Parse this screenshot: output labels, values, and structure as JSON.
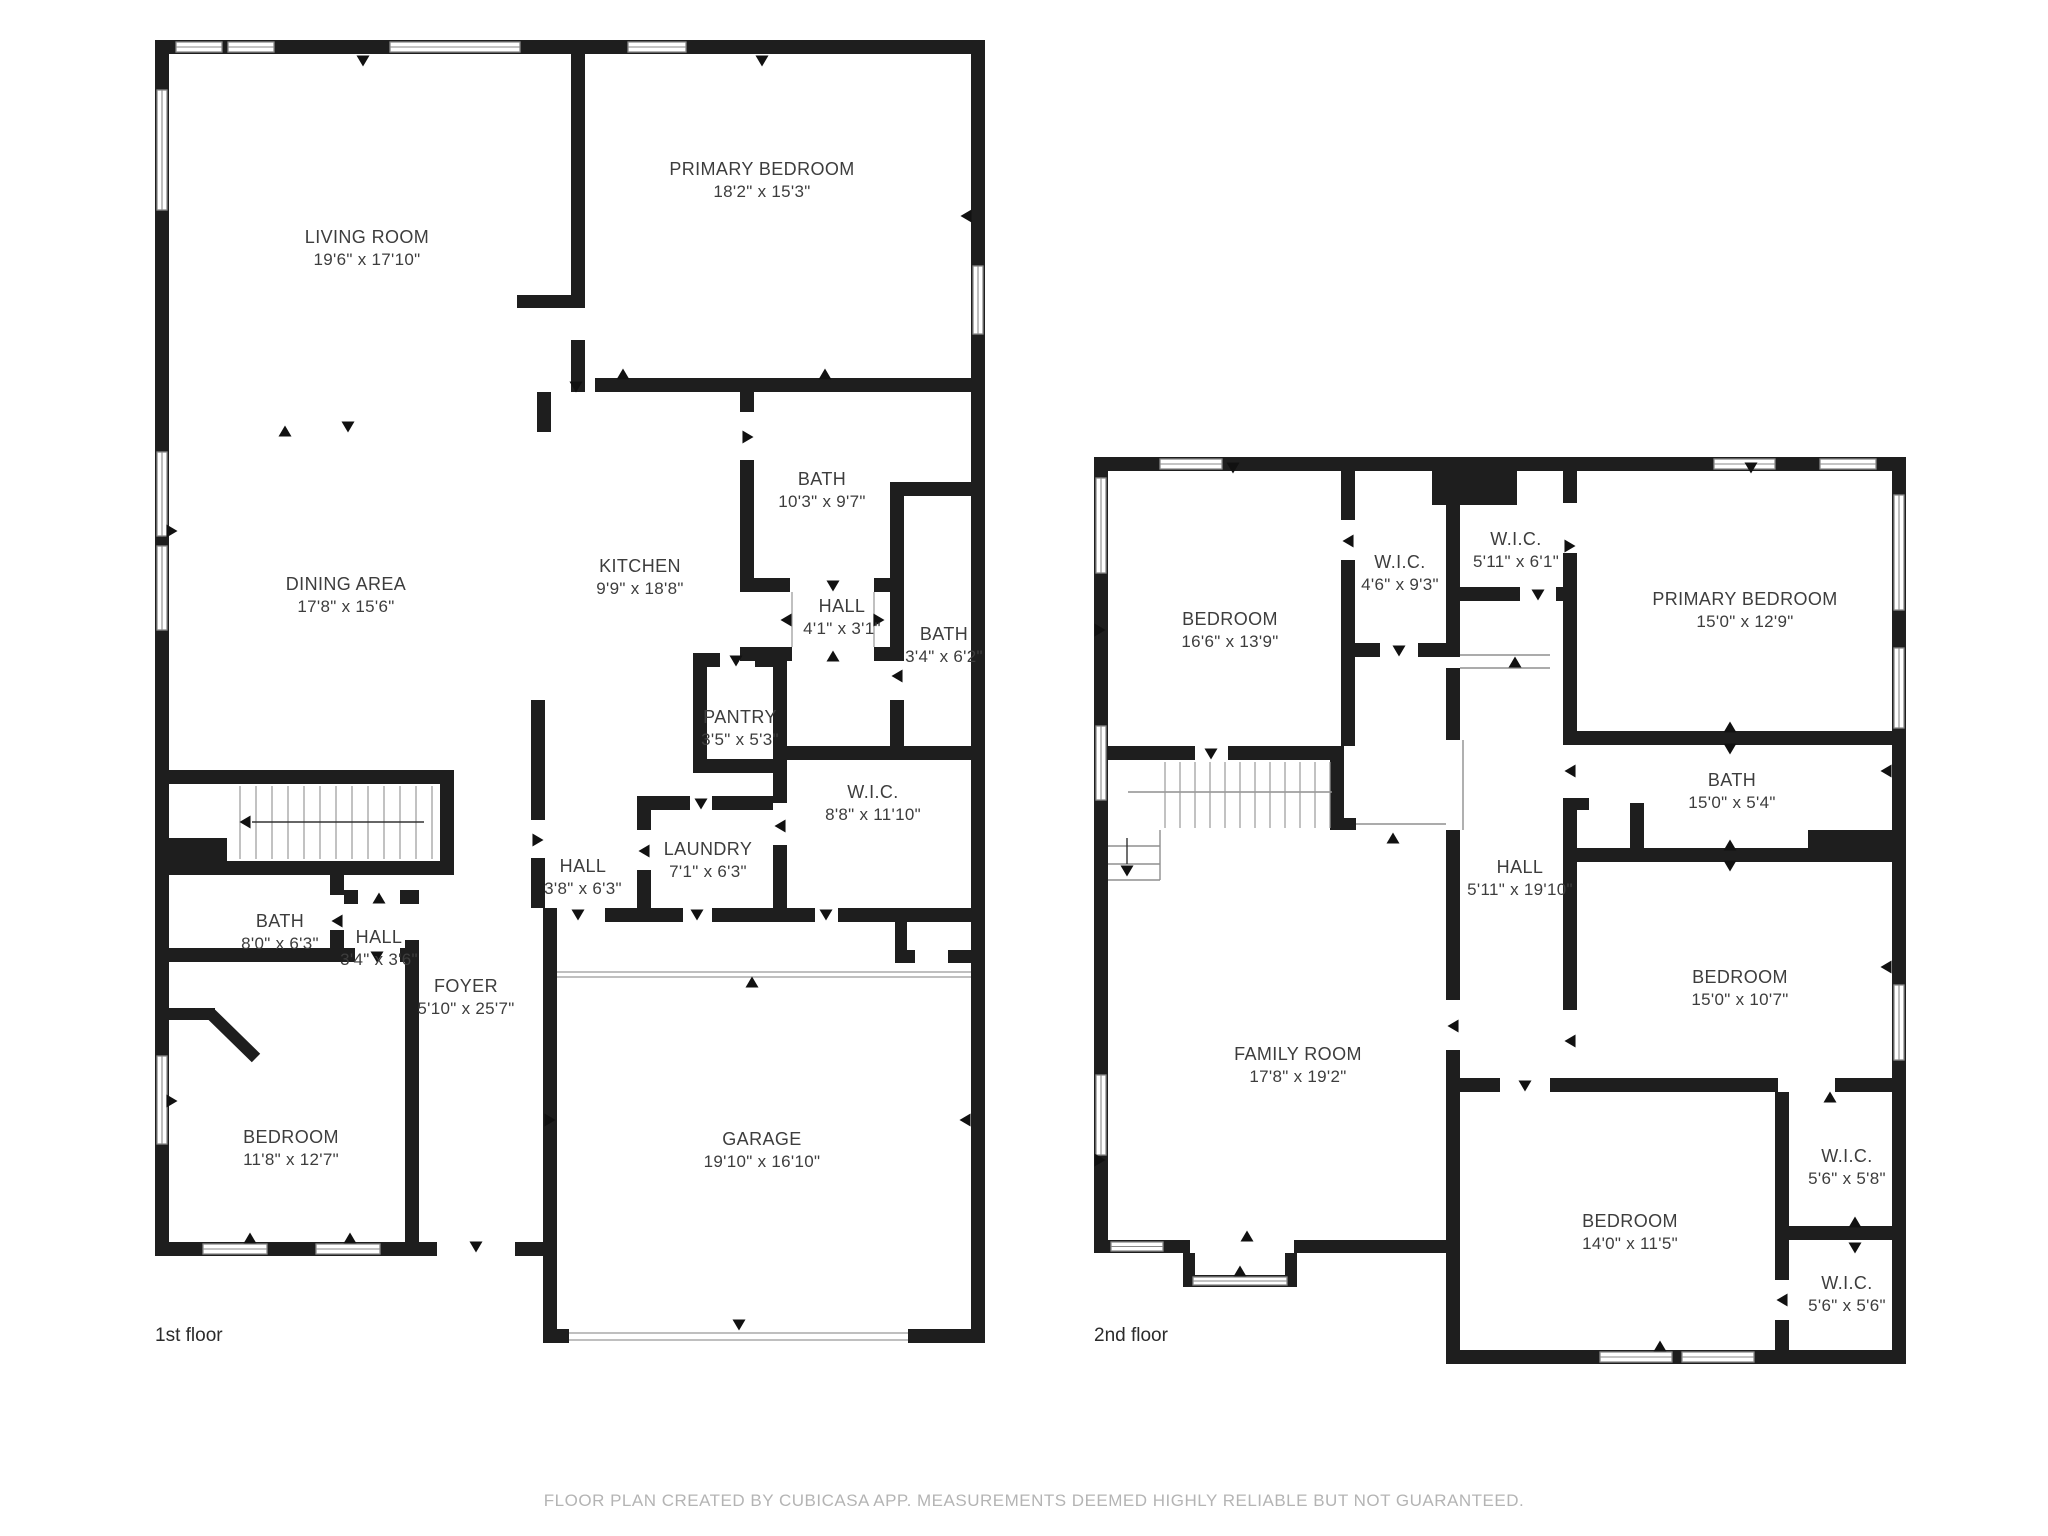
{
  "canvas": {
    "width": 2048,
    "height": 1536,
    "background": "#ffffff"
  },
  "palette": {
    "wall": "#1e1e1e",
    "room_label": "#3d3d3d",
    "floor_label": "#2b2b2b",
    "thin_line": "#8f8f8f",
    "stair_line": "#9a9a9a",
    "window_frame": "#8a8a8a",
    "garage_line": "#aaaaaa",
    "footer": "#b4b4b4"
  },
  "footer": {
    "text": "FLOOR PLAN CREATED BY CUBICASA APP. MEASUREMENTS DEEMED HIGHLY RELIABLE BUT NOT GUARANTEED."
  },
  "floors": [
    {
      "label": "1st floor",
      "label_pos": {
        "x": 155,
        "y": 1341
      },
      "rooms": [
        {
          "name": "LIVING ROOM",
          "dims": "19'6\" x 17'10\"",
          "x": 367,
          "y": 243
        },
        {
          "name": "PRIMARY BEDROOM",
          "dims": "18'2\" x 15'3\"",
          "x": 762,
          "y": 175
        },
        {
          "name": "DINING AREA",
          "dims": "17'8\" x 15'6\"",
          "x": 346,
          "y": 590
        },
        {
          "name": "KITCHEN",
          "dims": "9'9\" x 18'8\"",
          "x": 640,
          "y": 572
        },
        {
          "name": "BATH",
          "dims": "10'3\" x 9'7\"",
          "x": 822,
          "y": 485
        },
        {
          "name": "HALL",
          "dims": "4'1\" x 3'1\"",
          "x": 842,
          "y": 612
        },
        {
          "name": "BATH",
          "dims": "3'4\" x 6'2\"",
          "x": 944,
          "y": 640
        },
        {
          "name": "PANTRY",
          "dims": "3'5\" x 5'3\"",
          "x": 740,
          "y": 723
        },
        {
          "name": "W.I.C.",
          "dims": "8'8\" x 11'10\"",
          "x": 873,
          "y": 798
        },
        {
          "name": "HALL",
          "dims": "3'8\" x 6'3\"",
          "x": 583,
          "y": 872
        },
        {
          "name": "LAUNDRY",
          "dims": "7'1\" x 6'3\"",
          "x": 708,
          "y": 855
        },
        {
          "name": "BATH",
          "dims": "8'0\" x 6'3\"",
          "x": 280,
          "y": 927
        },
        {
          "name": "HALL",
          "dims": "3'4\" x 3'6\"",
          "x": 379,
          "y": 943
        },
        {
          "name": "FOYER",
          "dims": "5'10\" x 25'7\"",
          "x": 466,
          "y": 992
        },
        {
          "name": "BEDROOM",
          "dims": "11'8\" x 12'7\"",
          "x": 291,
          "y": 1143
        },
        {
          "name": "GARAGE",
          "dims": "19'10\" x 16'10\"",
          "x": 762,
          "y": 1145
        }
      ]
    },
    {
      "label": "2nd floor",
      "label_pos": {
        "x": 1094,
        "y": 1341
      },
      "rooms": [
        {
          "name": "BEDROOM",
          "dims": "16'6\" x 13'9\"",
          "x": 1230,
          "y": 625
        },
        {
          "name": "W.I.C.",
          "dims": "4'6\" x 9'3\"",
          "x": 1400,
          "y": 568
        },
        {
          "name": "W.I.C.",
          "dims": "5'11\" x 6'1\"",
          "x": 1516,
          "y": 545
        },
        {
          "name": "PRIMARY BEDROOM",
          "dims": "15'0\" x 12'9\"",
          "x": 1745,
          "y": 605
        },
        {
          "name": "BATH",
          "dims": "15'0\" x 5'4\"",
          "x": 1732,
          "y": 786
        },
        {
          "name": "HALL",
          "dims": "5'11\" x 19'10\"",
          "x": 1520,
          "y": 873
        },
        {
          "name": "BEDROOM",
          "dims": "15'0\" x 10'7\"",
          "x": 1740,
          "y": 983
        },
        {
          "name": "FAMILY ROOM",
          "dims": "17'8\" x 19'2\"",
          "x": 1298,
          "y": 1060
        },
        {
          "name": "W.I.C.",
          "dims": "5'6\" x 5'8\"",
          "x": 1847,
          "y": 1162
        },
        {
          "name": "BEDROOM",
          "dims": "14'0\" x 11'5\"",
          "x": 1630,
          "y": 1227
        },
        {
          "name": "W.I.C.",
          "dims": "5'6\" x 5'6\"",
          "x": 1847,
          "y": 1289
        }
      ]
    }
  ]
}
